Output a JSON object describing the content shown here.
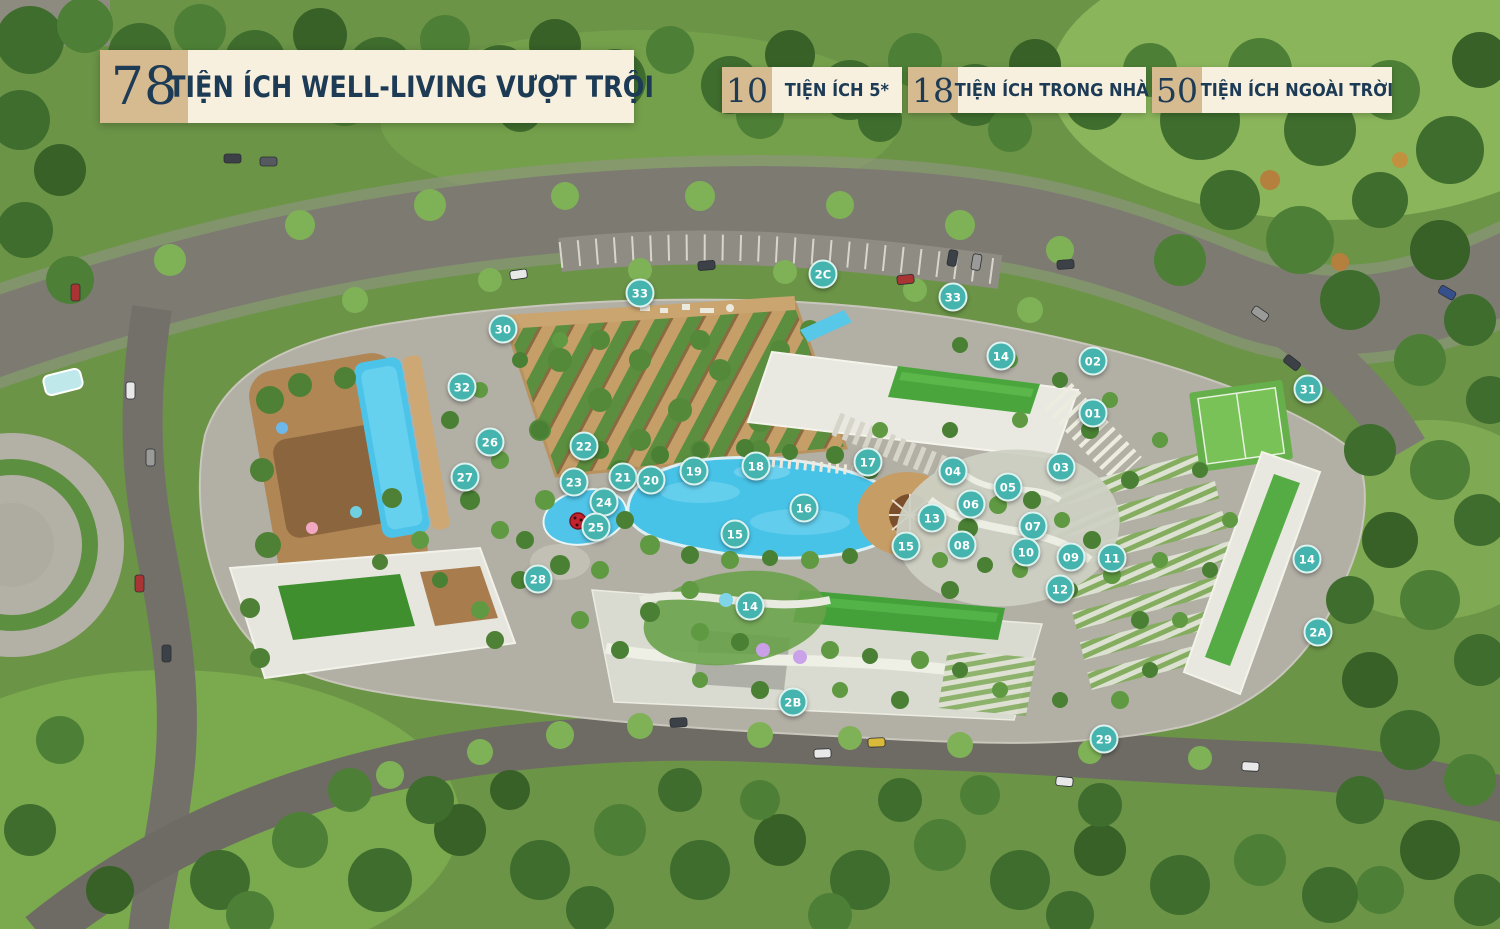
{
  "header": {
    "count": "78",
    "title": "TIỆN ÍCH WELL-LIVING VƯỢT TRỘI"
  },
  "stats": [
    {
      "value": "10",
      "label": "TIỆN ÍCH 5*"
    },
    {
      "value": "18",
      "label": "TIỆN ÍCH TRONG NHÀ"
    },
    {
      "value": "50",
      "label": "TIỆN ÍCH NGOÀI TRỜI"
    }
  ],
  "colors": {
    "marker_fill": "#45b4ae",
    "marker_ring": "#ddf3ef",
    "badge_number_bg": "#d6ba90",
    "badge_label_bg": "#f7f0df",
    "badge_text": "#1d3b55",
    "pool_blue": "#4cc4e9",
    "lawn_green": "#6b9447"
  },
  "markers": [
    {
      "label": "33",
      "x": 640,
      "y": 293
    },
    {
      "label": "2C",
      "x": 823,
      "y": 274
    },
    {
      "label": "33",
      "x": 953,
      "y": 297
    },
    {
      "label": "30",
      "x": 503,
      "y": 329
    },
    {
      "label": "14",
      "x": 1001,
      "y": 356
    },
    {
      "label": "02",
      "x": 1093,
      "y": 361
    },
    {
      "label": "32",
      "x": 462,
      "y": 387
    },
    {
      "label": "31",
      "x": 1308,
      "y": 389
    },
    {
      "label": "01",
      "x": 1093,
      "y": 413
    },
    {
      "label": "26",
      "x": 490,
      "y": 442
    },
    {
      "label": "22",
      "x": 584,
      "y": 446
    },
    {
      "label": "17",
      "x": 868,
      "y": 462
    },
    {
      "label": "18",
      "x": 756,
      "y": 466
    },
    {
      "label": "03",
      "x": 1061,
      "y": 467
    },
    {
      "label": "19",
      "x": 694,
      "y": 471
    },
    {
      "label": "04",
      "x": 953,
      "y": 471
    },
    {
      "label": "21",
      "x": 623,
      "y": 477
    },
    {
      "label": "27",
      "x": 465,
      "y": 477
    },
    {
      "label": "20",
      "x": 651,
      "y": 480
    },
    {
      "label": "23",
      "x": 574,
      "y": 482
    },
    {
      "label": "05",
      "x": 1008,
      "y": 487
    },
    {
      "label": "24",
      "x": 604,
      "y": 502
    },
    {
      "label": "06",
      "x": 971,
      "y": 504
    },
    {
      "label": "16",
      "x": 804,
      "y": 508
    },
    {
      "label": "13",
      "x": 932,
      "y": 518
    },
    {
      "label": "07",
      "x": 1033,
      "y": 526
    },
    {
      "label": "25",
      "x": 596,
      "y": 527
    },
    {
      "label": "15",
      "x": 735,
      "y": 534
    },
    {
      "label": "08",
      "x": 962,
      "y": 545
    },
    {
      "label": "15",
      "x": 906,
      "y": 546
    },
    {
      "label": "10",
      "x": 1026,
      "y": 552
    },
    {
      "label": "09",
      "x": 1071,
      "y": 557
    },
    {
      "label": "11",
      "x": 1112,
      "y": 558
    },
    {
      "label": "14",
      "x": 1307,
      "y": 559
    },
    {
      "label": "28",
      "x": 538,
      "y": 579
    },
    {
      "label": "12",
      "x": 1060,
      "y": 589
    },
    {
      "label": "14",
      "x": 750,
      "y": 606
    },
    {
      "label": "2A",
      "x": 1318,
      "y": 632
    },
    {
      "label": "2B",
      "x": 793,
      "y": 702
    },
    {
      "label": "29",
      "x": 1104,
      "y": 739
    }
  ]
}
